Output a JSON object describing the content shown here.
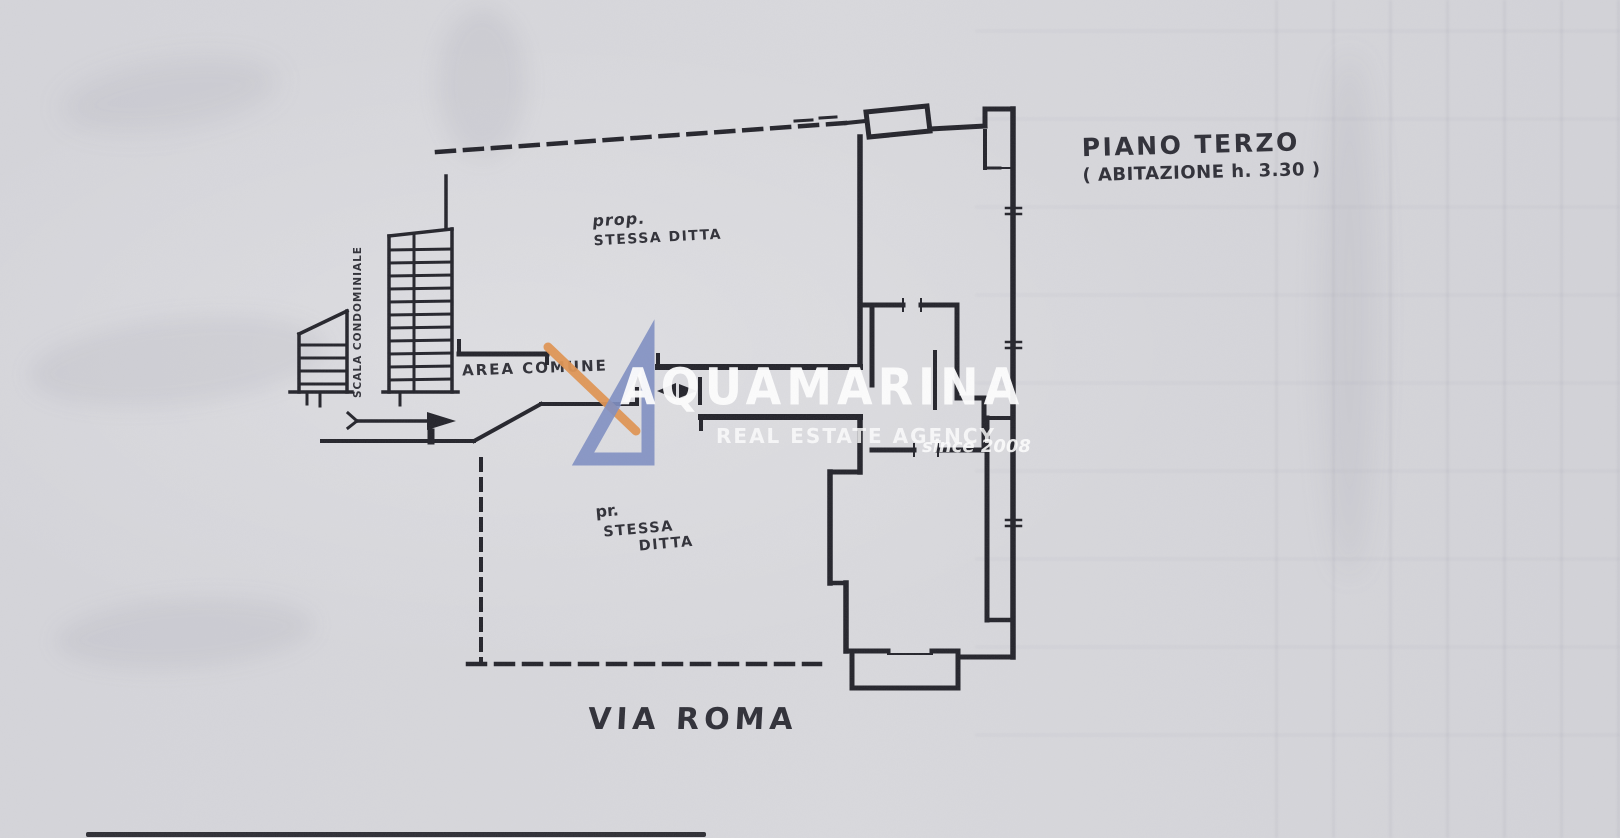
{
  "page": {
    "kind": "Scanned cadastral floor plan sheet"
  },
  "colors": {
    "paper": "#d8d8dc",
    "ink": "#23232a",
    "watermark_blue": "#7e8ec2",
    "watermark_orange": "#df9352",
    "watermark_text": "#ffffff"
  },
  "plan": {
    "floor_title": "PIANO TERZO",
    "floor_subtitle": "( ABITAZIONE h. 3.30 )",
    "street_label": "VIA ROMA",
    "stair_label": "SCALA CONDOMINIALE",
    "common_area_label": "AREA COMUNE",
    "owner_note_top": {
      "line1": "prop.",
      "line2": "STESSA DITTA"
    },
    "owner_note_bottom": {
      "line1": "pr.",
      "line2": "STESSA",
      "line3": "DITTA"
    }
  },
  "watermark": {
    "brand": "AQUAMARINA",
    "tagline": "REAL ESTATE AGENCY",
    "since": "since 2008"
  }
}
